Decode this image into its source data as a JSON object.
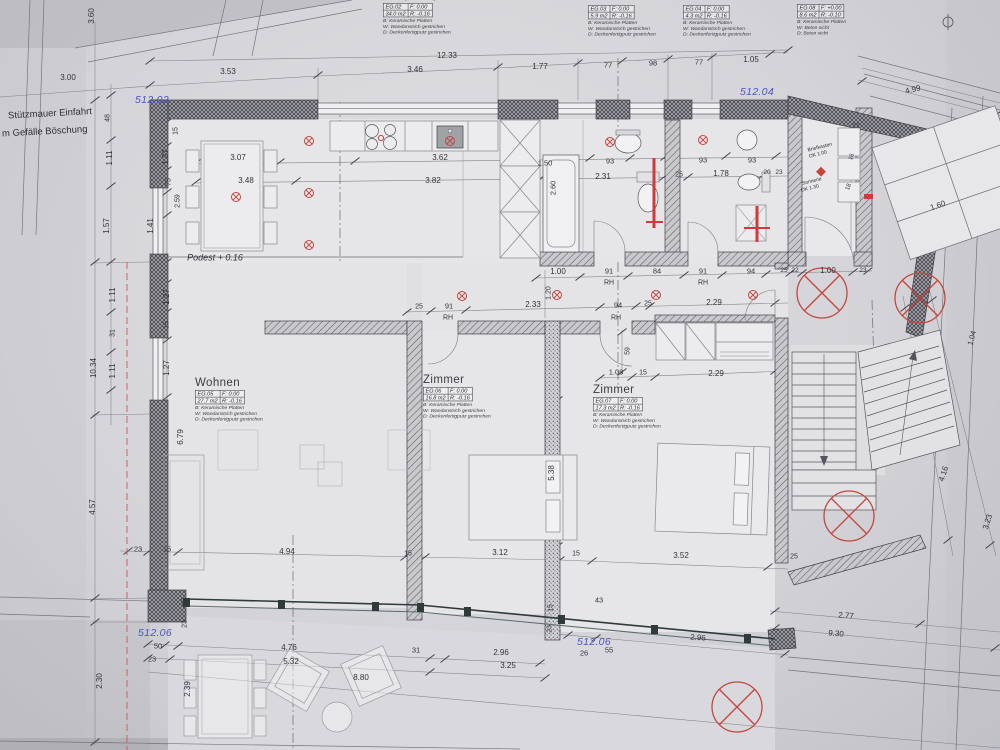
{
  "info_boxes": [
    {
      "title": "Küche, Essen, Flur",
      "id": "EG.02",
      "f": "F:   0.00",
      "area": "34.0 m2",
      "r": "R: -0.16",
      "lines": [
        "B: Keramische Platten",
        "W: Wandanstrich gestrichen",
        "D: Deckenfertigputz gestrichen"
      ]
    },
    {
      "title": "",
      "id": "EG.03",
      "f": "F:   0.00",
      "area": "5.9 m2",
      "r": "R: -0.16",
      "lines": [
        "B: Keramische Platten",
        "W: Wandanstrich gestrichen",
        "D: Deckenfertigputz gestrichen"
      ]
    },
    {
      "title": "",
      "id": "EG.04",
      "f": "F:   0.00",
      "area": "4.3 m2",
      "r": "R: -0.16",
      "lines": [
        "B: Keramische Platten",
        "W: Wandanstrich gestrichen",
        "D: Deckenfertigputz gestrichen"
      ]
    },
    {
      "title": "",
      "id": "EG.08",
      "f": "F: +0.00",
      "area": "8.6 m2",
      "r": "R: -0.10",
      "lines": [
        "B: Keramische Platten",
        "W: Beton sicht",
        "D: Beton sicht"
      ]
    }
  ],
  "rooms": [
    {
      "name": "Wohnen",
      "id": "EG.05",
      "f": "F:   0.00",
      "area": "27.7 m2",
      "r": "R: -0.16",
      "lines": [
        "B: Keramische Platten",
        "W: Wandanstrich gestrichen",
        "D: Deckenfertigputz gestrichen"
      ]
    },
    {
      "name": "Zimmer",
      "id": "EG.06",
      "f": "F:   0.00",
      "area": "16.8 m2",
      "r": "R: -0.16",
      "lines": [
        "B: Keramische Platten",
        "W: Wandanstrich gestrichen",
        "D: Deckenfertigputz gestrichen"
      ]
    },
    {
      "name": "Zimmer",
      "id": "EG.07",
      "f": "F:   0.00",
      "area": "17.3 m2",
      "r": "R: -0.16",
      "lines": [
        "B: Keramische Platten",
        "W: Wandanstrich gestrichen",
        "D: Deckenfertigputz gestrichen"
      ]
    }
  ],
  "elevations": [
    {
      "t": "512.02",
      "x": 152,
      "y": 100
    },
    {
      "t": "512.04",
      "x": 757,
      "y": 92
    },
    {
      "t": "512.06",
      "x": 155,
      "y": 633
    },
    {
      "t": "512.06",
      "x": 594,
      "y": 642
    }
  ],
  "labels": [
    {
      "t": "Stützmauer Einfahrt",
      "x": 8,
      "y": 114,
      "s": 9.5,
      "r": -3,
      "a": "left"
    },
    {
      "t": "m Gefälle Böschung",
      "x": 2,
      "y": 132,
      "s": 9.5,
      "r": -3,
      "a": "left"
    },
    {
      "t": "Podest + 0.16",
      "x": 215,
      "y": 258,
      "s": 9,
      "i": 1
    },
    {
      "t": "Briefkasten",
      "x": 820,
      "y": 148,
      "s": 5,
      "r": -14
    },
    {
      "t": "OK 1.00",
      "x": 818,
      "y": 155,
      "s": 5,
      "r": -14
    },
    {
      "t": "Sonnerie",
      "x": 812,
      "y": 182,
      "s": 5,
      "r": -14
    },
    {
      "t": "OK 1.30",
      "x": 810,
      "y": 189,
      "s": 5,
      "r": -14
    }
  ],
  "dims": [
    {
      "t": "12.33",
      "x": 447,
      "y": 56
    },
    {
      "t": "3.00",
      "x": 68,
      "y": 78
    },
    {
      "t": "3.53",
      "x": 228,
      "y": 72
    },
    {
      "t": "3.46",
      "x": 415,
      "y": 70
    },
    {
      "t": "1.77",
      "x": 540,
      "y": 67
    },
    {
      "t": "77",
      "x": 608,
      "y": 65,
      "s": 7.5
    },
    {
      "t": "98",
      "x": 653,
      "y": 63,
      "s": 7.5
    },
    {
      "t": "77",
      "x": 699,
      "y": 62,
      "s": 7.5
    },
    {
      "t": "1.05",
      "x": 751,
      "y": 60
    },
    {
      "t": "4.99",
      "x": 913,
      "y": 90,
      "r": -14
    },
    {
      "t": "3.60",
      "x": 92,
      "y": 16,
      "r": -90
    },
    {
      "t": "48",
      "x": 108,
      "y": 118,
      "r": -90,
      "s": 7
    },
    {
      "t": "1.11",
      "x": 110,
      "y": 158,
      "r": -90
    },
    {
      "t": "1.57",
      "x": 107,
      "y": 226,
      "r": -90
    },
    {
      "t": "1.11",
      "x": 113,
      "y": 295,
      "r": -90
    },
    {
      "t": "31",
      "x": 113,
      "y": 333,
      "r": -90,
      "s": 7
    },
    {
      "t": "1.11",
      "x": 113,
      "y": 371,
      "r": -90
    },
    {
      "t": "10.34",
      "x": 94,
      "y": 368,
      "r": -90
    },
    {
      "t": "4.57",
      "x": 93,
      "y": 507,
      "r": -90
    },
    {
      "t": "2.30",
      "x": 100,
      "y": 681,
      "r": -90
    },
    {
      "t": "15",
      "x": 176,
      "y": 131,
      "r": -90,
      "s": 7
    },
    {
      "t": "1.27",
      "x": 166,
      "y": 157,
      "r": -90
    },
    {
      "t": "75",
      "x": 169,
      "y": 182,
      "r": -90,
      "s": 7
    },
    {
      "t": "2.59",
      "x": 178,
      "y": 201,
      "r": -90,
      "s": 7
    },
    {
      "t": "1.41",
      "x": 151,
      "y": 226,
      "r": -90
    },
    {
      "t": "1.27",
      "x": 167,
      "y": 297,
      "r": -90
    },
    {
      "t": "15",
      "x": 167,
      "y": 325,
      "r": -90,
      "s": 7
    },
    {
      "t": "1.27",
      "x": 167,
      "y": 368,
      "r": -90
    },
    {
      "t": "6.79",
      "x": 181,
      "y": 437,
      "r": -90
    },
    {
      "t": "3.07",
      "x": 238,
      "y": 158
    },
    {
      "t": "3.48",
      "x": 246,
      "y": 181
    },
    {
      "t": "3.62",
      "x": 440,
      "y": 158
    },
    {
      "t": "3.82",
      "x": 433,
      "y": 181
    },
    {
      "t": "1.50",
      "x": 545,
      "y": 163,
      "s": 7.5
    },
    {
      "t": "93",
      "x": 610,
      "y": 161,
      "s": 7.5
    },
    {
      "t": "93",
      "x": 703,
      "y": 160,
      "s": 7.5
    },
    {
      "t": "93",
      "x": 752,
      "y": 160,
      "s": 7.5
    },
    {
      "t": "2.31",
      "x": 603,
      "y": 177
    },
    {
      "t": "25",
      "x": 679,
      "y": 175,
      "s": 7
    },
    {
      "t": "1.78",
      "x": 721,
      "y": 174
    },
    {
      "t": "20",
      "x": 767,
      "y": 173,
      "s": 6.5
    },
    {
      "t": "23",
      "x": 779,
      "y": 173,
      "s": 6.5
    },
    {
      "t": "2.60",
      "x": 553,
      "y": 188,
      "r": -90,
      "s": 7.5
    },
    {
      "t": "1.00",
      "x": 558,
      "y": 272
    },
    {
      "t": "91",
      "x": 609,
      "y": 271,
      "s": 7.5
    },
    {
      "t": "84",
      "x": 657,
      "y": 271,
      "s": 7.5
    },
    {
      "t": "91",
      "x": 703,
      "y": 271,
      "s": 7.5
    },
    {
      "t": "94",
      "x": 751,
      "y": 271,
      "s": 7.5
    },
    {
      "t": "RH",
      "x": 609,
      "y": 283,
      "s": 7
    },
    {
      "t": "RH",
      "x": 703,
      "y": 283,
      "s": 7
    },
    {
      "t": "25",
      "x": 784,
      "y": 271,
      "s": 6.5
    },
    {
      "t": "22",
      "x": 795,
      "y": 271,
      "s": 6.5
    },
    {
      "t": "1.00",
      "x": 828,
      "y": 271
    },
    {
      "t": "23",
      "x": 863,
      "y": 271,
      "s": 6.5
    },
    {
      "t": "25",
      "x": 419,
      "y": 307,
      "s": 7
    },
    {
      "t": "91",
      "x": 449,
      "y": 306,
      "s": 7.5
    },
    {
      "t": "RH",
      "x": 448,
      "y": 318,
      "s": 7
    },
    {
      "t": "2.33",
      "x": 533,
      "y": 305
    },
    {
      "t": "94",
      "x": 618,
      "y": 305,
      "s": 7.5
    },
    {
      "t": "RH",
      "x": 616,
      "y": 318,
      "s": 7
    },
    {
      "t": "25",
      "x": 648,
      "y": 304,
      "s": 7
    },
    {
      "t": "2.29",
      "x": 714,
      "y": 303
    },
    {
      "t": "1.20",
      "x": 549,
      "y": 293,
      "r": -90,
      "s": 7
    },
    {
      "t": "59",
      "x": 628,
      "y": 351,
      "r": -90,
      "s": 7
    },
    {
      "t": "1.08",
      "x": 616,
      "y": 372,
      "s": 7.5
    },
    {
      "t": "15",
      "x": 643,
      "y": 373,
      "s": 7
    },
    {
      "t": "2.29",
      "x": 716,
      "y": 374
    },
    {
      "t": "1.60",
      "x": 938,
      "y": 206,
      "r": -19
    },
    {
      "t": "23",
      "x": 856,
      "y": 127,
      "s": 6.5
    },
    {
      "t": "16",
      "x": 852,
      "y": 157,
      "r": -72,
      "s": 6
    },
    {
      "t": "18",
      "x": 849,
      "y": 187,
      "r": -72,
      "s": 6
    },
    {
      "t": "1.04",
      "x": 972,
      "y": 338,
      "r": -75,
      "s": 7.5
    },
    {
      "t": "4.16",
      "x": 944,
      "y": 474,
      "r": -72
    },
    {
      "t": "3.23",
      "x": 988,
      "y": 522,
      "r": -72
    },
    {
      "t": "5.38",
      "x": 552,
      "y": 473,
      "r": -90
    },
    {
      "t": "3.12",
      "x": 500,
      "y": 553
    },
    {
      "t": "15",
      "x": 408,
      "y": 554,
      "s": 7
    },
    {
      "t": "15",
      "x": 576,
      "y": 554,
      "s": 7
    },
    {
      "t": "3.52",
      "x": 681,
      "y": 556
    },
    {
      "t": "25",
      "x": 794,
      "y": 557,
      "s": 7
    },
    {
      "t": "43",
      "x": 599,
      "y": 600,
      "s": 7.5
    },
    {
      "t": "15",
      "x": 551,
      "y": 608,
      "r": -90,
      "s": 7
    },
    {
      "t": "23",
      "x": 550,
      "y": 629,
      "r": -90,
      "s": 7
    },
    {
      "t": "23",
      "x": 138,
      "y": 549,
      "s": 7.5
    },
    {
      "t": "15",
      "x": 167,
      "y": 549,
      "s": 7.5
    },
    {
      "t": "4.94",
      "x": 287,
      "y": 552
    },
    {
      "t": "15",
      "x": 185,
      "y": 602,
      "r": -90,
      "s": 7
    },
    {
      "t": "23",
      "x": 185,
      "y": 624,
      "r": -90,
      "s": 7
    },
    {
      "t": "50",
      "x": 158,
      "y": 646,
      "s": 7.5
    },
    {
      "t": "23",
      "x": 152,
      "y": 659,
      "s": 7.5
    },
    {
      "t": "4.76",
      "x": 289,
      "y": 648
    },
    {
      "t": "5.32",
      "x": 291,
      "y": 662
    },
    {
      "t": "8.80",
      "x": 361,
      "y": 678
    },
    {
      "t": "31",
      "x": 416,
      "y": 650,
      "s": 7.5
    },
    {
      "t": "2.96",
      "x": 501,
      "y": 653
    },
    {
      "t": "3.25",
      "x": 508,
      "y": 666
    },
    {
      "t": "26",
      "x": 584,
      "y": 653,
      "s": 7.5
    },
    {
      "t": "55",
      "x": 609,
      "y": 650,
      "s": 7.5
    },
    {
      "t": "2.96",
      "x": 698,
      "y": 638,
      "r": 4
    },
    {
      "t": "2.77",
      "x": 846,
      "y": 616,
      "r": 5
    },
    {
      "t": "9.30",
      "x": 836,
      "y": 634,
      "r": 5
    },
    {
      "t": "2.39",
      "x": 188,
      "y": 689,
      "r": -90
    }
  ]
}
